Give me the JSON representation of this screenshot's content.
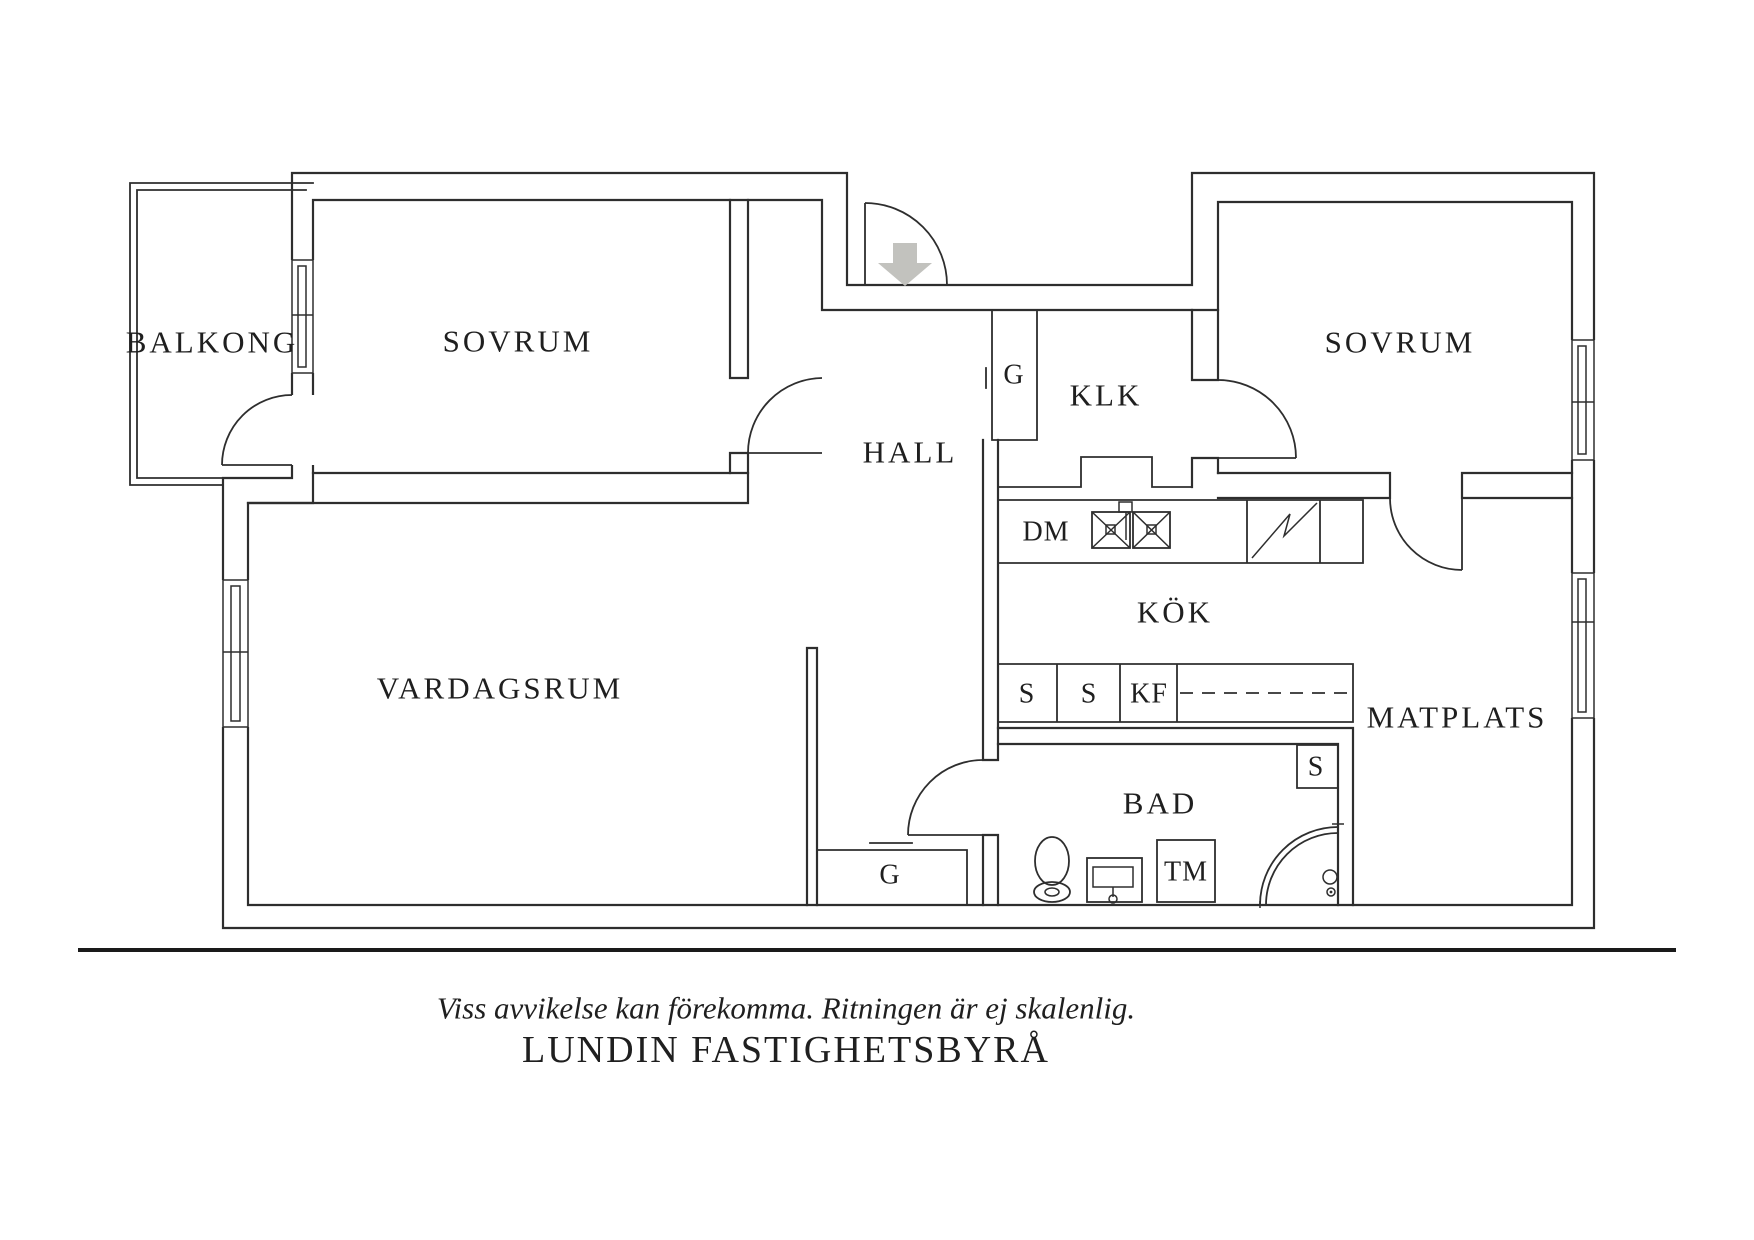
{
  "plan": {
    "rooms": {
      "balkong": "BALKONG",
      "sovrum_left": "SOVRUM",
      "sovrum_right": "SOVRUM",
      "hall": "HALL",
      "klk": "KLK",
      "kok": "KÖK",
      "vardagsrum": "VARDAGSRUM",
      "matplats": "MATPLATS",
      "bad": "BAD"
    },
    "fixtures": {
      "closet_hall": "G",
      "closet_vardagsrum": "G",
      "dishwasher": "DM",
      "cabinet_1": "S",
      "cabinet_2": "S",
      "fridge_freezer": "KF",
      "closet_bad": "S",
      "washing_machine": "TM"
    },
    "colors": {
      "line": "#2e2e2e",
      "text": "#1f1f1f",
      "arrow_fill": "#c2c2be"
    }
  },
  "footer": {
    "disclaimer": "Viss avvikelse kan förekomma. Ritningen är ej skalenlig.",
    "agency": "LUNDIN FASTIGHETSBYRÅ"
  }
}
